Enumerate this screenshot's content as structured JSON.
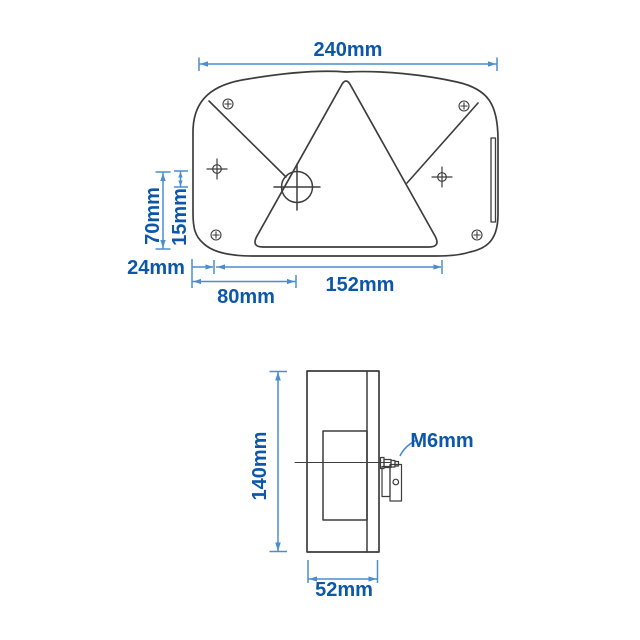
{
  "drawing": {
    "title": "Rear lamp technical drawing with dimensions",
    "views": {
      "front": {
        "label_width": "240mm",
        "label_height": "70mm",
        "label_offset": "15mm",
        "label_edge_to_hole": "24mm",
        "label_edge_to_center": "80mm",
        "label_hole_spacing": "152mm"
      },
      "side": {
        "label_height": "140mm",
        "label_depth": "52mm",
        "label_bolt": "M6mm"
      }
    },
    "colors": {
      "dimension_line": "#4a8ecf",
      "dimension_text": "#0d57a9",
      "drawing_line": "#3d3d3d",
      "background": "#ffffff"
    }
  }
}
